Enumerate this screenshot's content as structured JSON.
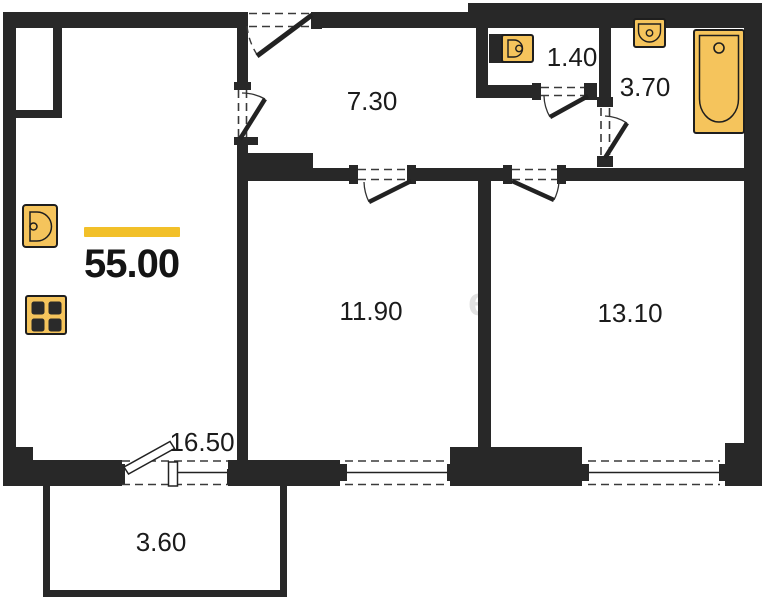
{
  "plan": {
    "total_area": "55.00",
    "watermark": "e",
    "rooms": [
      {
        "id": "hallway",
        "area": "7.30"
      },
      {
        "id": "wc",
        "area": "1.40"
      },
      {
        "id": "bathroom",
        "area": "3.70"
      },
      {
        "id": "room-11-90",
        "area": "11.90"
      },
      {
        "id": "room-13-10",
        "area": "13.10"
      },
      {
        "id": "living-kitchen",
        "area": "16.50"
      },
      {
        "id": "balcony",
        "area": "3.60"
      }
    ],
    "fixtures": [
      "kitchen-sink-icon",
      "stove-icon",
      "wc-sink-icon",
      "bath-sink-icon",
      "bathtub-icon"
    ],
    "colors": {
      "wall": "#282828",
      "fixture_fill": "#f5c45c",
      "fixture_border": "#1e1e1e",
      "accent_bar": "#f2c029",
      "background": "#ffffff",
      "watermark": "#e2e2e2"
    }
  }
}
